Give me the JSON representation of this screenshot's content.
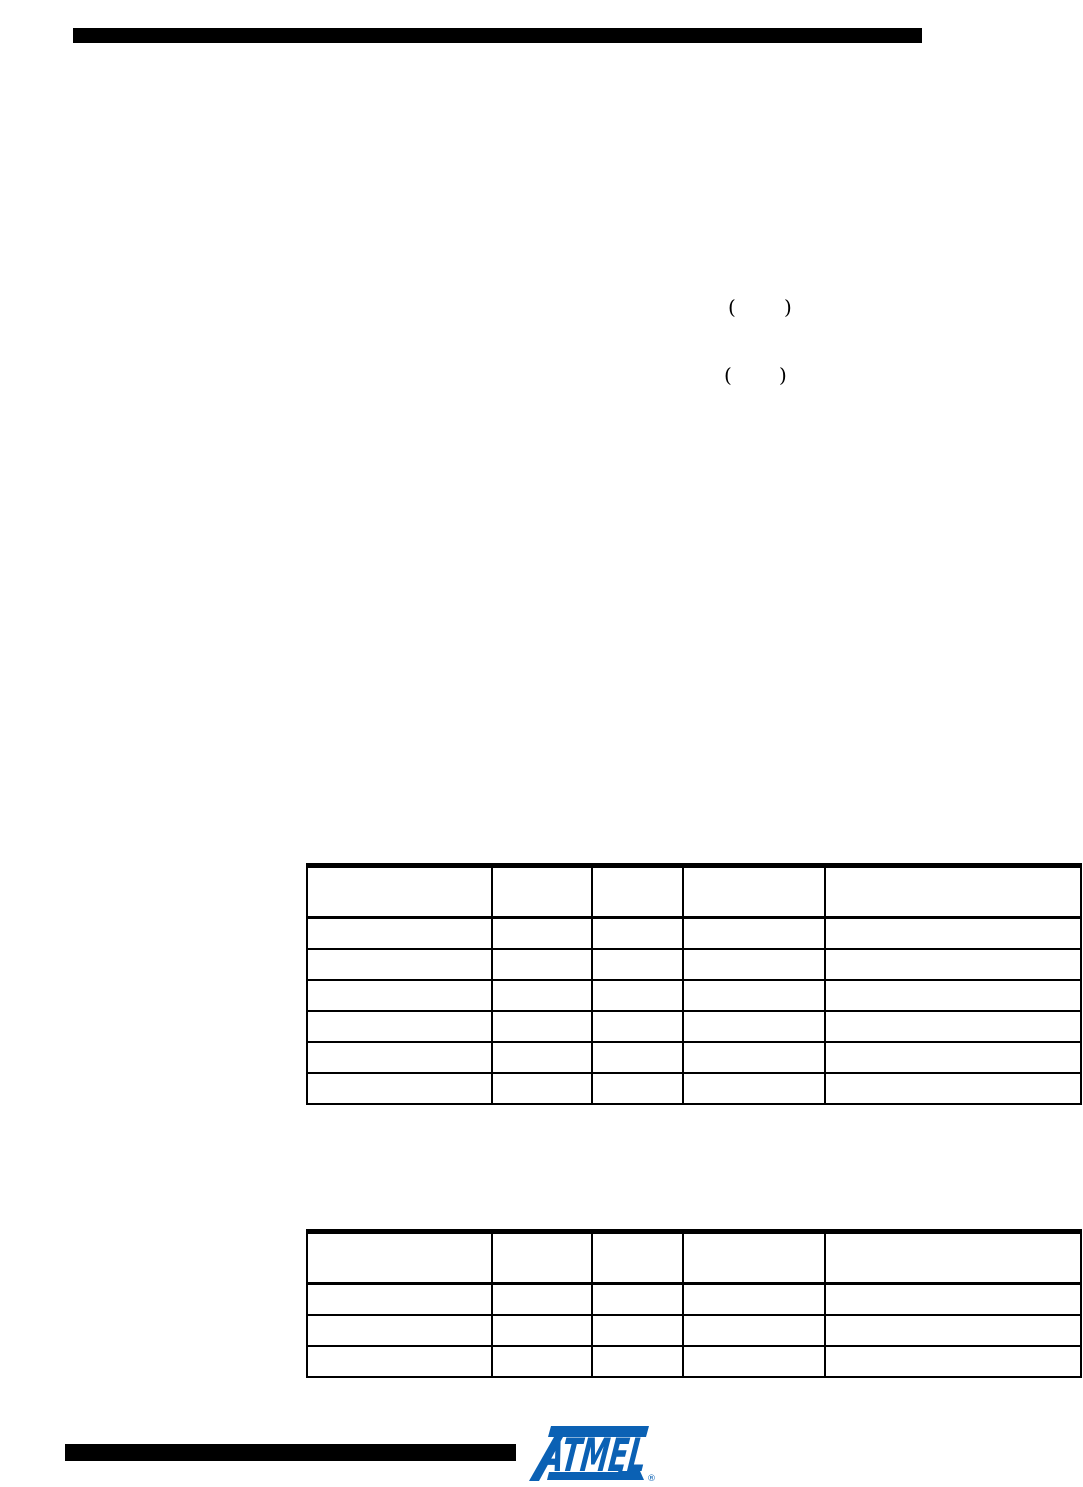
{
  "page": {
    "background_color": "#ffffff",
    "rule_color": "#000000",
    "table_border_color": "#000000"
  },
  "inline_fragments": {
    "paren_pair_1": {
      "open": "(",
      "close": ")"
    },
    "paren_pair_2": {
      "open": "(",
      "close": ")"
    }
  },
  "table_1": {
    "header": [
      "",
      "",
      "",
      "",
      ""
    ],
    "rows": [
      [
        "",
        "",
        "",
        "",
        ""
      ],
      [
        "",
        "",
        "",
        "",
        ""
      ],
      [
        "",
        "",
        "",
        "",
        ""
      ],
      [
        "",
        "",
        "",
        "",
        ""
      ],
      [
        "",
        "",
        "",
        "",
        ""
      ],
      [
        "",
        "",
        "",
        "",
        ""
      ]
    ]
  },
  "table_2": {
    "header": [
      "",
      "",
      "",
      "",
      ""
    ],
    "rows": [
      [
        "",
        "",
        "",
        "",
        ""
      ],
      [
        "",
        "",
        "",
        "",
        ""
      ],
      [
        "",
        "",
        "",
        "",
        ""
      ]
    ]
  },
  "footer": {
    "logo_text": "ATMEL",
    "registered_mark": "®",
    "logo_color": "#0b61b4"
  }
}
